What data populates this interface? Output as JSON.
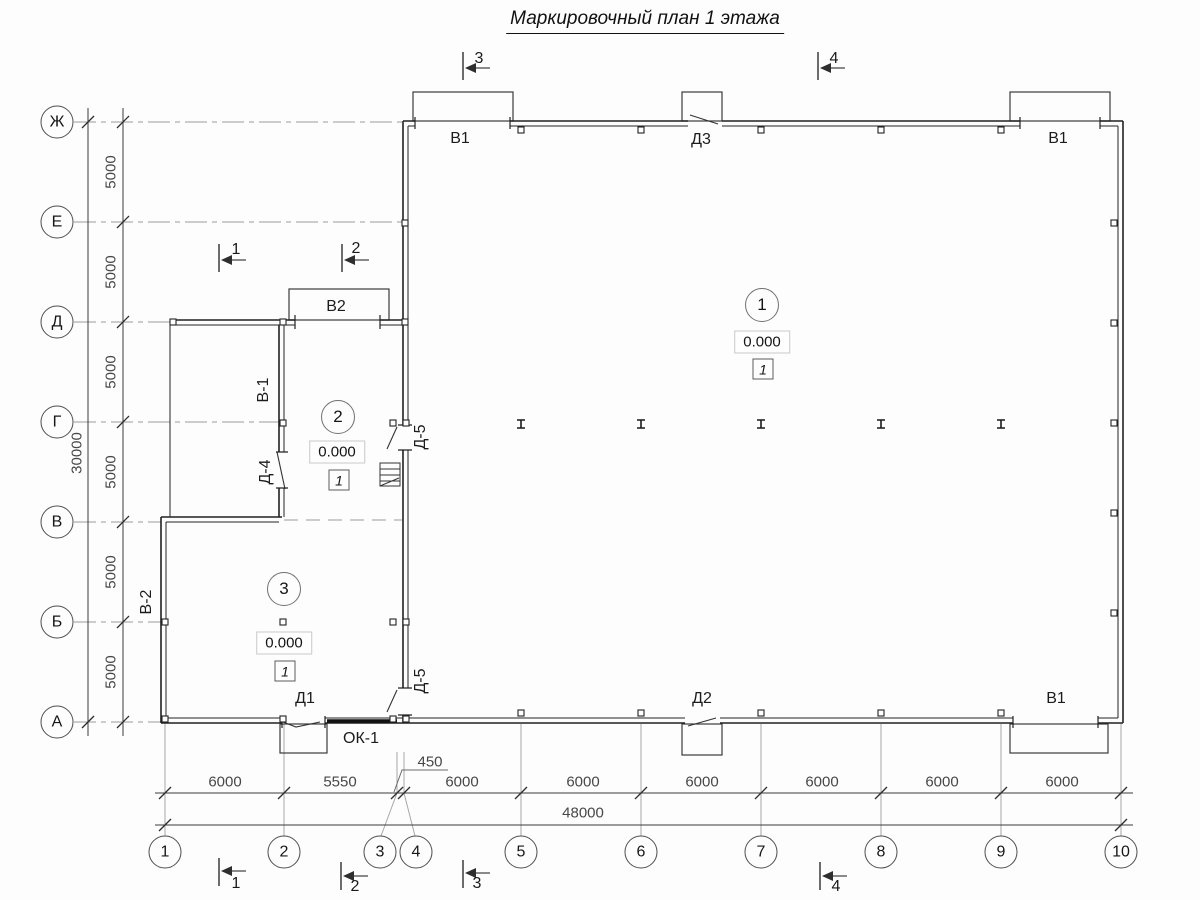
{
  "title": "Маркировочный план 1 этажа",
  "axis_rows": [
    {
      "label": "Ж"
    },
    {
      "label": "Е"
    },
    {
      "label": "Д"
    },
    {
      "label": "Г"
    },
    {
      "label": "В"
    },
    {
      "label": "Б"
    },
    {
      "label": "А"
    }
  ],
  "axis_cols": [
    {
      "label": "1"
    },
    {
      "label": "2"
    },
    {
      "label": "3"
    },
    {
      "label": "4"
    },
    {
      "label": "5"
    },
    {
      "label": "6"
    },
    {
      "label": "7"
    },
    {
      "label": "8"
    },
    {
      "label": "9"
    },
    {
      "label": "10"
    }
  ],
  "dims": {
    "left": [
      {
        "value": "5000"
      },
      {
        "value": "5000"
      },
      {
        "value": "5000"
      },
      {
        "value": "5000"
      },
      {
        "value": "5000"
      },
      {
        "value": "5000"
      }
    ],
    "left_total": "30000",
    "bottom": [
      {
        "value": "6000"
      },
      {
        "value": "5550"
      },
      {
        "value": "450"
      },
      {
        "value": "6000"
      },
      {
        "value": "6000"
      },
      {
        "value": "6000"
      },
      {
        "value": "6000"
      },
      {
        "value": "6000"
      },
      {
        "value": "6000"
      }
    ],
    "bottom_total": "48000"
  },
  "sections": {
    "top3": "3",
    "top4": "4",
    "mid1": "1",
    "mid2": "2",
    "bot1": "1",
    "bot2": "2",
    "bot3": "3",
    "bot4": "4"
  },
  "labels": {
    "v1_top_left": "В1",
    "d3_top": "Д3",
    "v1_top_right": "В1",
    "v2": "В2",
    "v_1_wall": "В-1",
    "d_4": "Д-4",
    "d_5_upper": "Д-5",
    "d_5_lower": "Д-5",
    "v_2_wall": "В-2",
    "d1": "Д1",
    "ok1": "ОК-1",
    "d2": "Д2",
    "v1_bottom": "В1"
  },
  "rooms": [
    {
      "number": "1",
      "elevation": "0.000",
      "finish": "1"
    },
    {
      "number": "2",
      "elevation": "0.000",
      "finish": "1"
    },
    {
      "number": "3",
      "elevation": "0.000",
      "finish": "1"
    }
  ],
  "colors": {
    "wall": "#222222",
    "axis_line": "#9a9a9a",
    "dim_line": "#3c3c3c",
    "text": "#1c1c1c"
  }
}
